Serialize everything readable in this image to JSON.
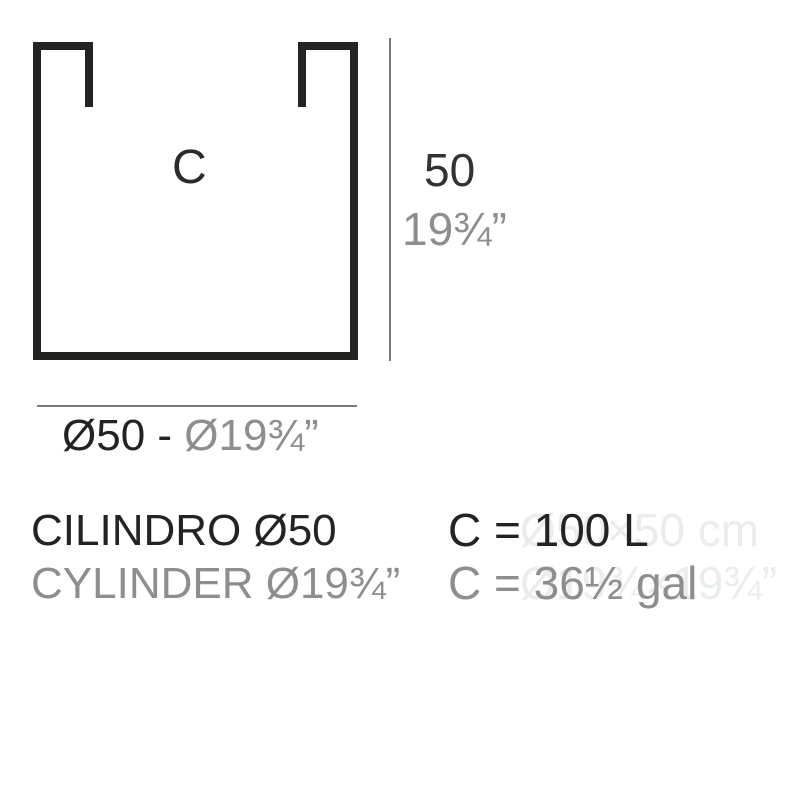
{
  "colors": {
    "ink": "#232321",
    "gray": "#8e8e8e",
    "line": "#7a7a7a",
    "ghost": "#eaedee",
    "background": "#ffffff"
  },
  "diagram": {
    "volume_label": "C",
    "height_cm": "50",
    "height_in": "19¾”",
    "diameter_cm": "Ø50 - ",
    "diameter_in": "Ø19¾”"
  },
  "product": {
    "name_es": "CILINDRO Ø50",
    "name_en": "CYLINDER Ø19¾”",
    "capacity_liters": "C = 100 L",
    "capacity_gallons": "C = 36½ gal",
    "watermark_dimensions_cm": "Ø50×50 cm",
    "watermark_dimensions_in": "Ø19¾×19¾”"
  }
}
